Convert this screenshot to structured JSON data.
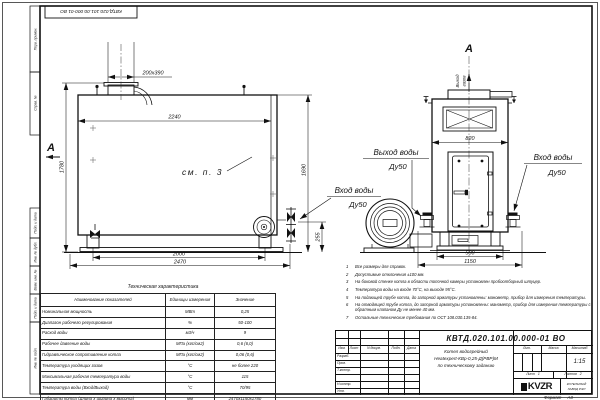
{
  "doc": {
    "number": "КВТД.020.101.00.000-01  ВО",
    "number_top": "КВТД.020.101.00.000-01 ВО",
    "format_label": "Формат",
    "format_value": "А3"
  },
  "frame_labels": {
    "perv": "Перв. примен.",
    "sprav": "Справ. №",
    "podp1": "Подп. и дата",
    "inv_dubl": "Инв. № дубл.",
    "vzam": "Взам. инв. №",
    "podp2": "Подп. и дата",
    "inv_podl": "Инв. № подл."
  },
  "drawing": {
    "section_letter": "А",
    "see_note": "см. п. 3",
    "gas_outlet_word1": "Выход",
    "gas_outlet_word2": "газов",
    "water_outlet": "Выход воды",
    "water_inlet": "Вход воды",
    "dn": "Ду50",
    "dims": {
      "stub": "200х390",
      "body_len": "2240",
      "h_total": "1780",
      "h_right": "1690",
      "conn_h": "255",
      "leg_span": "2000",
      "overall_len": "2470",
      "front_w": "820",
      "base_w": "580",
      "overall_w": "1150"
    }
  },
  "tech_table": {
    "title": "Техническая характеристика",
    "headers": [
      "Наименование показателей",
      "Единицы измерения",
      "Значение"
    ],
    "rows": [
      [
        "Номинальная мощность",
        "МВт",
        "0,25"
      ],
      [
        "Диапазон рабочего регулирования",
        "%",
        "50-100"
      ],
      [
        "Расход воды",
        "м3/ч",
        "9"
      ],
      [
        "Рабочее давление воды",
        "МПа (кгс/см2)",
        "0,6 (6,0)"
      ],
      [
        "Гидравлическое сопротивление котла",
        "МПа (кгс/см2)",
        "0,06 (0,6)"
      ],
      [
        "Температура уходящих газов",
        "°С",
        "не более 220"
      ],
      [
        "Максимальная рабочая температура воды",
        "°С",
        "115"
      ],
      [
        "Температура воды (Вход/Выход)",
        "°С",
        "70/95"
      ],
      [
        "Габариты котла (Длина х ширина х высота)",
        "мм",
        "2470х1150х1780"
      ]
    ]
  },
  "notes": [
    {
      "n": "1",
      "text": "Все размеры для справок."
    },
    {
      "n": "2",
      "text": "Допустимые отклонения ±100 мм."
    },
    {
      "n": "3",
      "text": "На боковой стенке котла в области топочной камеры установлен пробоотборный штуцер."
    },
    {
      "n": "4",
      "text": "Температура воды на входе 70°С, на выходе 95°С."
    },
    {
      "n": "5",
      "text": "На подающей трубе котла, до запорной арматуры установлены: манометр, прибор для измерения температуры."
    },
    {
      "n": "6",
      "text": "На отводящей трубе котла, до запорной арматуры установлены: манометр, прибор для измерения температуры с обратным клапаном Ду не менее 40 мм."
    },
    {
      "n": "7",
      "text": "Остальные технические требования по ОСТ 108.030.135-84."
    }
  ],
  "title_block": {
    "col_izm": "Изм.",
    "col_list": "Лист",
    "col_ndoc": "N докум.",
    "col_podp": "Подп.",
    "col_data": "Дата",
    "row_razrab": "Разраб.",
    "row_prov": "Пров.",
    "row_tkontr": "Т.контр.",
    "row_nkontr": "Н.контр.",
    "row_utv": "Утв.",
    "name_line1": "Котел водогрейный",
    "name_line2": "Heatexpert-КВр-0,25-Д(РВР)М",
    "name_line3": "по техническому заданию",
    "lit_label": "Лит.",
    "mass_label": "Масса",
    "scale_label": "Масштаб",
    "scale_value": "1:15",
    "sheet_label": "Лист",
    "sheet_value": "1",
    "sheets_label": "Листов",
    "sheets_value": "2",
    "logo_text": "KVZR",
    "company_line1": "КОТЕЛЬНЫЙ",
    "company_line2": "ЗАВОД РЭП"
  }
}
